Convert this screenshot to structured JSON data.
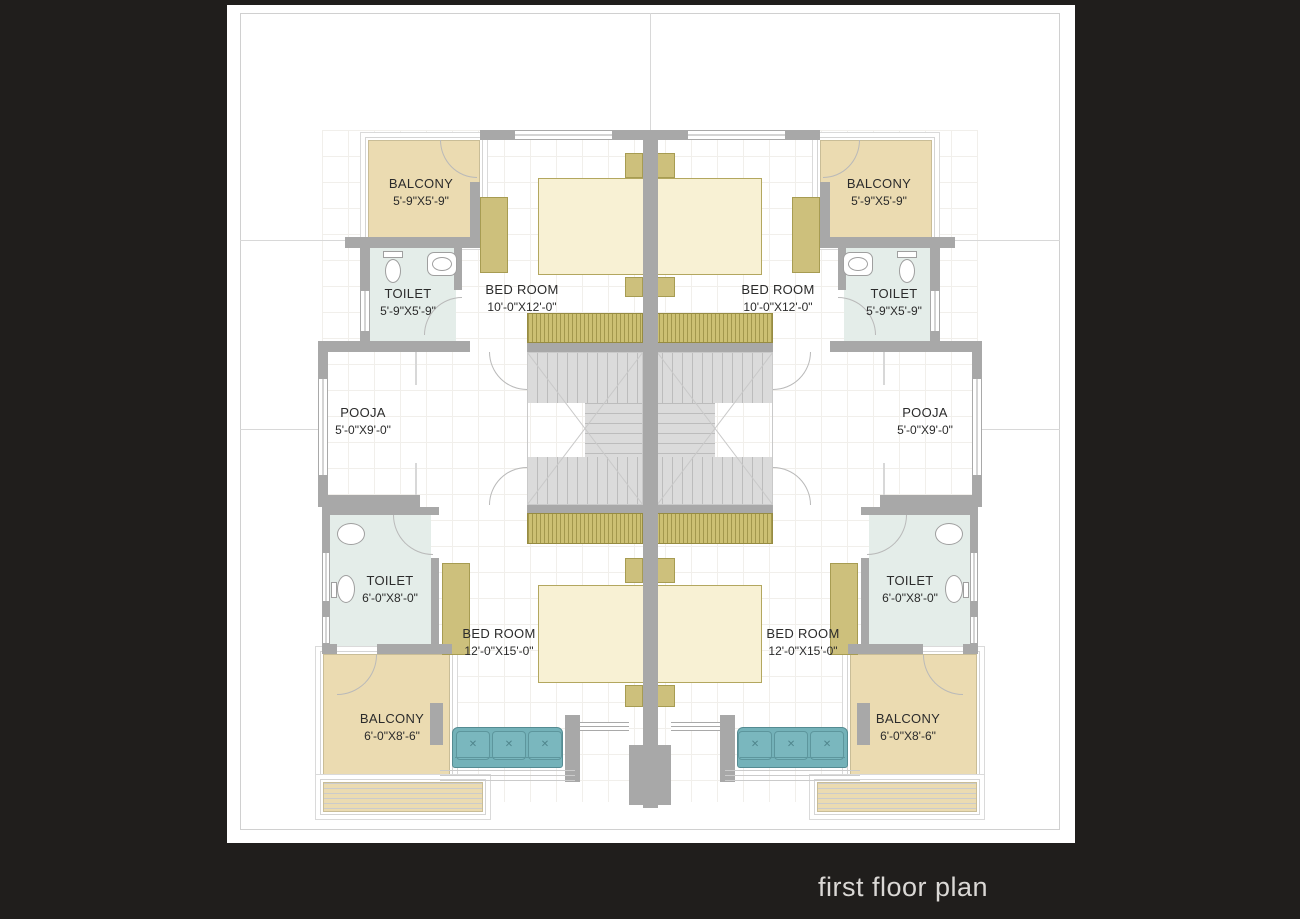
{
  "title": "first floor plan",
  "colors": {
    "background": "#201e1c",
    "sheet": "#ffffff",
    "wall": "#a8a8a8",
    "balcony_floor": "#ebdbb1",
    "toilet_floor": "#e4ede9",
    "bed": "#f8f1d4",
    "furniture_olive": "#cdc07c",
    "sofa": "#74b2b9",
    "stairs": "#dbdbdb",
    "label_text": "#2b2b2b",
    "title_text": "#dad8d5"
  },
  "rooms": {
    "balcony_top_left": {
      "name": "BALCONY",
      "dims": "5'-9\"X5'-9\""
    },
    "balcony_top_right": {
      "name": "BALCONY",
      "dims": "5'-9\"X5'-9\""
    },
    "toilet_top_left": {
      "name": "TOILET",
      "dims": "5'-9\"X5'-9\""
    },
    "toilet_top_right": {
      "name": "TOILET",
      "dims": "5'-9\"X5'-9\""
    },
    "bedroom_top_left": {
      "name": "BED ROOM",
      "dims": "10'-0\"X12'-0\""
    },
    "bedroom_top_right": {
      "name": "BED ROOM",
      "dims": "10'-0\"X12'-0\""
    },
    "pooja_left": {
      "name": "POOJA",
      "dims": "5'-0\"X9'-0\""
    },
    "pooja_right": {
      "name": "POOJA",
      "dims": "5'-0\"X9'-0\""
    },
    "toilet_bottom_left": {
      "name": "TOILET",
      "dims": "6'-0\"X8'-0\""
    },
    "toilet_bottom_right": {
      "name": "TOILET",
      "dims": "6'-0\"X8'-0\""
    },
    "bedroom_bottom_left": {
      "name": "BED ROOM",
      "dims": "12'-0\"X15'-0\""
    },
    "bedroom_bottom_right": {
      "name": "BED ROOM",
      "dims": "12'-0\"X15'-0\""
    },
    "balcony_bottom_left": {
      "name": "BALCONY",
      "dims": "6'-0\"X8'-6\""
    },
    "balcony_bottom_right": {
      "name": "BALCONY",
      "dims": "6'-0\"X8'-6\""
    }
  }
}
